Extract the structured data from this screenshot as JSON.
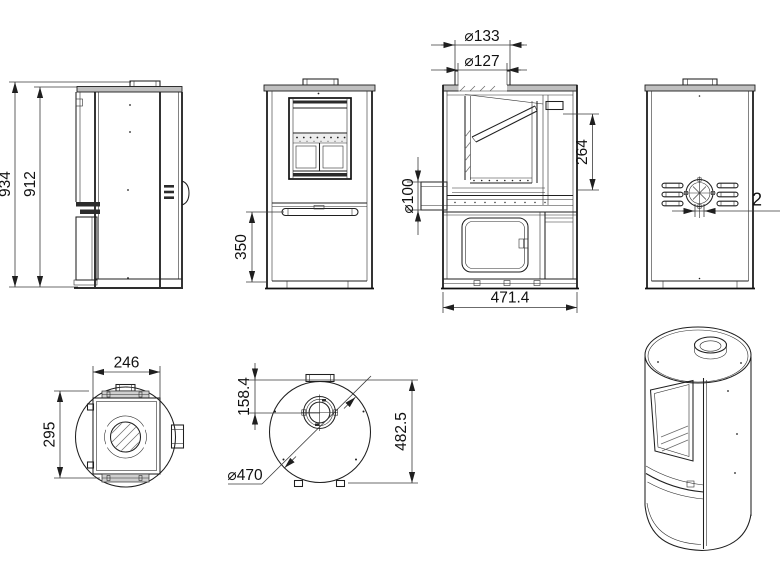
{
  "drawing_type": "stove-technical-drawing",
  "colors": {
    "background": "#ffffff",
    "line": "#1f1f1f",
    "dimension_line": "#3a3a3a",
    "text": "#111111",
    "top_plate_fill": "#bfbfbf",
    "cap_fill": "#cfcfcf"
  },
  "views": {
    "side": {
      "overall_height": "934",
      "body_height": "912"
    },
    "front": {
      "base_door_height": "350"
    },
    "section": {
      "collar_outer": "⌀133",
      "collar_inner": "⌀127",
      "rear_outlet": "⌀100",
      "window_height": "264",
      "depth": "471.4"
    },
    "rear": {
      "offset_partial": "2"
    },
    "plan_base": {
      "width": "246",
      "depth": "295"
    },
    "plan_top": {
      "flue_offset": "158.4",
      "depth": "482.5",
      "diameter": "⌀470"
    }
  }
}
